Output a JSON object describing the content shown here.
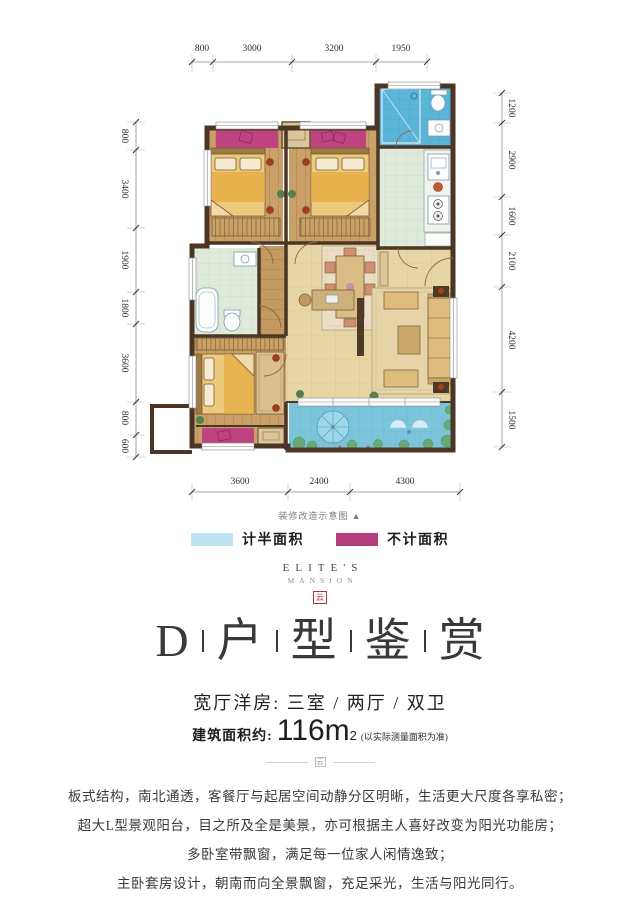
{
  "plan": {
    "note": "装修改造示意图 ▲",
    "dims": {
      "top": [
        "800",
        "3000",
        "3200",
        "1950"
      ],
      "left": [
        "800",
        "3400",
        "1900",
        "1800",
        "3600",
        "800",
        "600"
      ],
      "right": [
        "1200",
        "2900",
        "1600",
        "2100",
        "4200",
        "1500"
      ],
      "bottom": [
        "3600",
        "2400",
        "4300"
      ]
    },
    "colors": {
      "wall": "#4b3625",
      "wood_floor": "#c9a067",
      "tile_floor": "#e8d5a5",
      "wet_room": "#e0eadb",
      "bath_blue": "#5ab5d8",
      "balcony_blue": "#7cc4da",
      "bay_pink": "#bf4380"
    }
  },
  "legend": {
    "items": [
      {
        "label": "计半面积",
        "color": "#bfe3f2"
      },
      {
        "label": "不计面积",
        "color": "#b23c7c"
      }
    ]
  },
  "brand": {
    "name": "ELITE'S",
    "sub": "MANSION",
    "mark": "云"
  },
  "title": {
    "parts": [
      "D",
      "户",
      "型",
      "鉴",
      "赏"
    ]
  },
  "subtitle": "宽厅洋房: 三室 / 两厅 / 双卫",
  "area": {
    "prefix": "建筑面积约:",
    "value": "116m",
    "sup": "2",
    "note": "(以实际测量面积为准)"
  },
  "paragraphs": [
    "板式结构，南北通透，客餐厅与起居空间动静分区明晰，生活更大尺度各享私密；",
    "超大L型景观阳台，目之所及全是美景，亦可根据主人喜好改变为阳光功能房；",
    "多卧室带飘窗，满足每一位家人闲情逸致；",
    "主卧套房设计，朝南而向全景飘窗，充足采光，生活与阳光同行。"
  ]
}
